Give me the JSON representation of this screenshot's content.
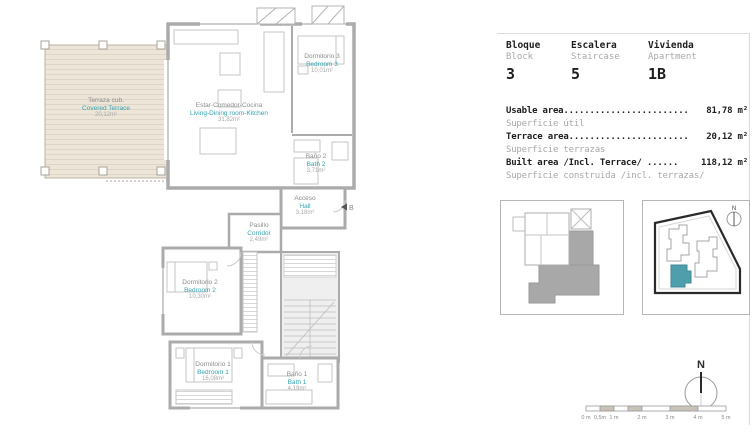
{
  "header": {
    "fields": [
      {
        "label": "Bloque",
        "sub": "Block",
        "value": "3"
      },
      {
        "label": "Escalera",
        "sub": "Staircase",
        "value": "5"
      },
      {
        "label": "Vivienda",
        "sub": "Apartment",
        "value": "1B"
      }
    ]
  },
  "areas": [
    {
      "label_dots": "Usable area........................",
      "value": "81,78 m²",
      "sub": "Superficie útil"
    },
    {
      "label_dots": "Terrace area.......................",
      "value": "20,12 m²",
      "sub": "Superficie terrazas"
    },
    {
      "label_dots": "Built area /Incl. Terrace/ ......",
      "value": "118,12 m²",
      "sub": "Superficie construida /incl. terrazas/"
    }
  ],
  "plan": {
    "rooms": [
      {
        "name_es": "Terraza cub.",
        "name_en": "Covered Terrace",
        "area": "20,12m²"
      },
      {
        "name_es": "Estar-Comedor-Cocina",
        "name_en": "Living-Dining room-Kitchen",
        "area": "31,82m²"
      },
      {
        "name_es": "Dormitorio 3",
        "name_en": "Bedroom 3",
        "area": "10,01m²"
      },
      {
        "name_es": "Baño 2",
        "name_en": "Bath 2",
        "area": "3,71m²"
      },
      {
        "name_es": "Acceso",
        "name_en": "Hall",
        "area": "3,18m²"
      },
      {
        "name_es": "Pasillo",
        "name_en": "Corridor",
        "area": "2,49m²"
      },
      {
        "name_es": "Dormitorio 2",
        "name_en": "Bedroom 2",
        "area": "10,30m²"
      },
      {
        "name_es": "Dormitorio 1",
        "name_en": "Bedroom 1",
        "area": "16,08m²"
      },
      {
        "name_es": "Baño 1",
        "name_en": "Bath 1",
        "area": "4,19m²"
      }
    ],
    "entrance_label": "B"
  },
  "compass": {
    "label": "N"
  },
  "scalebar": {
    "labels": [
      "0 m",
      "0,5m",
      "1 m",
      "2 m",
      "3 m",
      "4 m",
      "5 m"
    ]
  },
  "colors": {
    "accent_teal": "#35a3b2",
    "wall_gray": "#ababab",
    "terrace_fill": "#ece5d8",
    "site_highlight": "#4e9eac"
  }
}
